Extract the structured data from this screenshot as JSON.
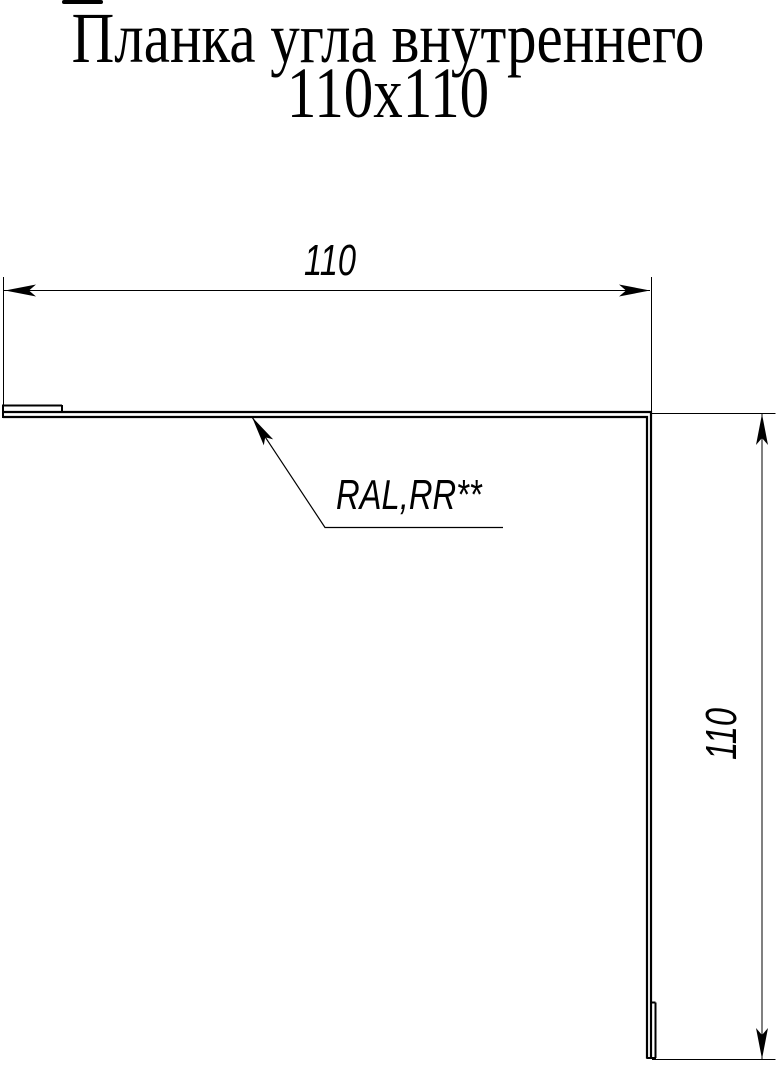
{
  "page": {
    "background_color": "#ffffff",
    "line_color": "#000000"
  },
  "title": {
    "line1": "Планка угла внутреннего",
    "line2": "110х110"
  },
  "drawing": {
    "width_dimension_label": "110",
    "height_dimension_label": "110",
    "material_callout_label": "RAL,RR**"
  }
}
